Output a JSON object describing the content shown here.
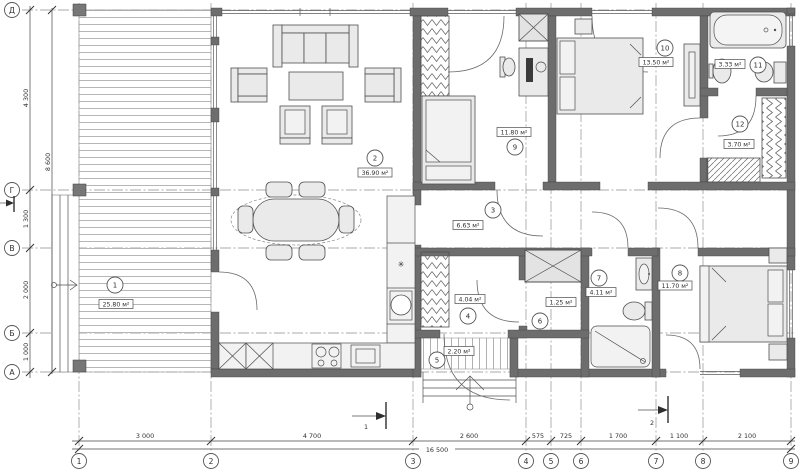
{
  "plan": {
    "rooms": [
      {
        "number": "1",
        "area": "25.80 м²"
      },
      {
        "number": "2",
        "area": "36.90 м²"
      },
      {
        "number": "3",
        "area": "6.63 м²"
      },
      {
        "number": "4",
        "area": "4.04 м²"
      },
      {
        "number": "5",
        "area": "2.20 м²"
      },
      {
        "number": "6",
        "area": "1.25 м²"
      },
      {
        "number": "7",
        "area": "4.11 м²"
      },
      {
        "number": "8",
        "area": "11.70 м²"
      },
      {
        "number": "9",
        "area": "11.80 м²"
      },
      {
        "number": "10",
        "area": "13.50 м²"
      },
      {
        "number": "11",
        "area": "3.33 м²"
      },
      {
        "number": "12",
        "area": "3.70 м²"
      }
    ],
    "axes_letters": [
      "Д",
      "Г",
      "В",
      "Б",
      "А"
    ],
    "axes_numbers": [
      "1",
      "2",
      "3",
      "4",
      "5",
      "6",
      "7",
      "8",
      "9"
    ],
    "dims_left": [
      "4 300",
      "1 300",
      "2 000",
      "1 000"
    ],
    "dims_left_total": "8 600",
    "dims_bottom": [
      "3 000",
      "4 700",
      "2 600",
      "575",
      "725",
      "1 700",
      "1 100",
      "2 100"
    ],
    "dims_bottom_total": "16 500",
    "section_marks": [
      "1",
      "2"
    ],
    "symbols": {
      "star": "✳"
    },
    "colors": {
      "wall": "#6d6d6d",
      "furniture": "#eaeaea",
      "line": "#4f4f4f"
    }
  }
}
